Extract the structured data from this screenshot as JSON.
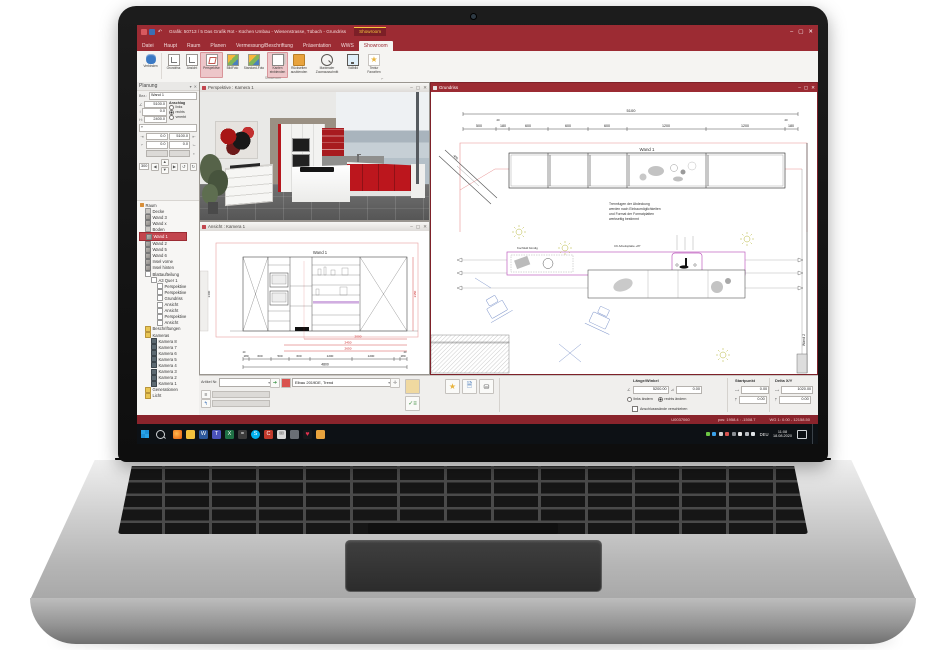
{
  "titlebar": {
    "title": "Grafik: 50713 / 5 Das Grafik Rot - Küchen Umbau - Wiesenstrasse, Tübach - Grundriss",
    "context_tab": "Showroom"
  },
  "ribbon": {
    "tabs": [
      "Datei",
      "Haupt",
      "Raum",
      "Planen",
      "Vermessung/Beschriftung",
      "Präsentation",
      "WWS",
      "Showroom"
    ],
    "active_tab": "Showroom",
    "buttons": [
      {
        "label": "Verbinden"
      },
      {
        "label": "Grundriss"
      },
      {
        "label": "Ansicht"
      },
      {
        "label": "Perspektive"
      },
      {
        "label": "BildFoto"
      },
      {
        "label": "Standard-Foto"
      },
      {
        "label": "Kanten\neinblenden"
      },
      {
        "label": "Rückseiten\nausblenden"
      },
      {
        "label": "Maximaler\nZoomausschnitt"
      },
      {
        "label": "Vollbild"
      },
      {
        "label": "Textur\nFavoriten"
      }
    ],
    "group_label": "Showroom"
  },
  "panel": {
    "title": "Planung",
    "bez_label": "Bez.:",
    "bez_value": "Wand 1",
    "len_value": "5100.0",
    "anschlag_label": "Anschlag",
    "anschlag_options": [
      "links",
      "rechts",
      "vererbt"
    ],
    "off_value": "0.0",
    "h_label": "H:",
    "h_value": "2400.0",
    "g1": "0.0",
    "g2": "5100.0",
    "g3": "0.0",
    "g4": "0.0",
    "step": "300"
  },
  "tree": {
    "items": [
      {
        "label": "Raum"
      },
      {
        "label": "Decke"
      },
      {
        "label": "Wand 3"
      },
      {
        "label": "Wand x"
      },
      {
        "label": "Boden"
      },
      {
        "label": "Wand 1"
      },
      {
        "label": "Wand 2"
      },
      {
        "label": "Wand 5"
      },
      {
        "label": "Wand 6"
      },
      {
        "label": "Insel vorne"
      },
      {
        "label": "Insel hinten"
      },
      {
        "label": "Blattaufteilung"
      },
      {
        "label": "A3 Quer 1"
      },
      {
        "label": "Perspektive"
      },
      {
        "label": "Perspektive"
      },
      {
        "label": "Grundriss"
      },
      {
        "label": "Ansicht"
      },
      {
        "label": "Ansicht"
      },
      {
        "label": "Perspektive"
      },
      {
        "label": "Ansicht"
      },
      {
        "label": "Beschriftungen"
      },
      {
        "label": "Kameras"
      },
      {
        "label": "Kamera 8"
      },
      {
        "label": "Kamera 7"
      },
      {
        "label": "Kamera 6"
      },
      {
        "label": "Kamera 5"
      },
      {
        "label": "Kamera 4"
      },
      {
        "label": "Kamera 3"
      },
      {
        "label": "Kamera 2"
      },
      {
        "label": "Kamera 1"
      },
      {
        "label": "Generationen"
      },
      {
        "label": "Licht"
      }
    ]
  },
  "persp": {
    "title": "Perspektive : Kamera 1"
  },
  "ansicht": {
    "title": "Ansicht : Kamera 1",
    "wall": "Wand 1",
    "total": "4800",
    "d": [
      "180",
      "600",
      "500",
      "600",
      "1200",
      "1200",
      "180"
    ],
    "s": [
      "20",
      "20"
    ],
    "red": [
      "2000",
      "2450",
      "2650"
    ],
    "left_dim": "2400",
    "right_dim": "2350"
  },
  "grundriss": {
    "title": "Grundriss",
    "total": "5100",
    "d": [
      "500",
      "180",
      "600",
      "600",
      "600",
      "1200",
      "1200",
      "180"
    ],
    "s": [
      "20",
      "20"
    ],
    "wall": "Wand 1",
    "wall2": "Wand 2",
    "diag": "400",
    "note": [
      "Trennfugen der Abdeckung",
      "werden nach Einbaumöglichkeiten",
      "und Format der Formatplatten",
      "werkseitig bestimmt"
    ],
    "cap1": "Kochfeld bündig",
    "cap2": "CK Arbeitsplatte +87"
  },
  "toolbar": {
    "artikel_label": "Artikel Nr.",
    "catalog": "Elbau 2019DE, Trend",
    "laenge_label": "Länge/Winkel",
    "len": "5200.00",
    "ang": "0.00",
    "r1": "links ändern",
    "r2": "rechts ändern",
    "chk": "Anschlusswände verschieben",
    "start_label": "Startpunkt",
    "sx": "0.00",
    "sy": "0.00",
    "delta_label": "Delta X/Y",
    "dx": "1020.00",
    "dy": "0.00"
  },
  "status": {
    "id": "U0037060",
    "pos": "pos: 1958.4 : -1508.7",
    "wg": "WG 1: 0.00 - 12158.50"
  },
  "taskbar": {
    "lang": "DEU",
    "time": "11:08",
    "date": "18.08.2020"
  }
}
